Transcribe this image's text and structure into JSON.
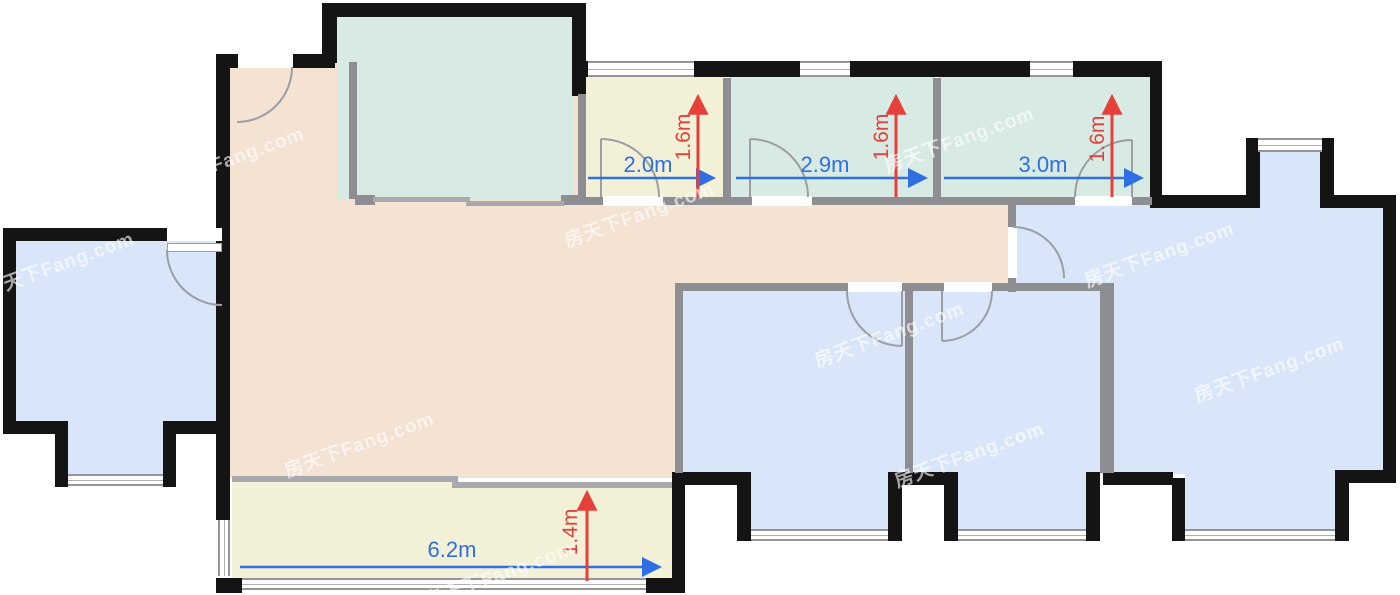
{
  "floorplan": {
    "watermark_text": "房天下Fang.com",
    "colors": {
      "room_blue": "#d9e6fa",
      "room_teal": "#d7ebe4",
      "room_yellow": "#f2f0d7",
      "room_beige": "#f4e2d2",
      "wall_exterior": "#141414",
      "wall_interior": "#8e8e92",
      "dim_blue": "#2f6fe4",
      "dim_red": "#e6403a"
    },
    "dimensions": {
      "room_a": {
        "width": "2.0m",
        "depth": "1.6m"
      },
      "room_b": {
        "width": "2.9m",
        "depth": "1.6m"
      },
      "room_c": {
        "width": "3.0m",
        "depth": "1.6m"
      },
      "balcony": {
        "width": "6.2m",
        "depth": "1.4m"
      }
    }
  }
}
